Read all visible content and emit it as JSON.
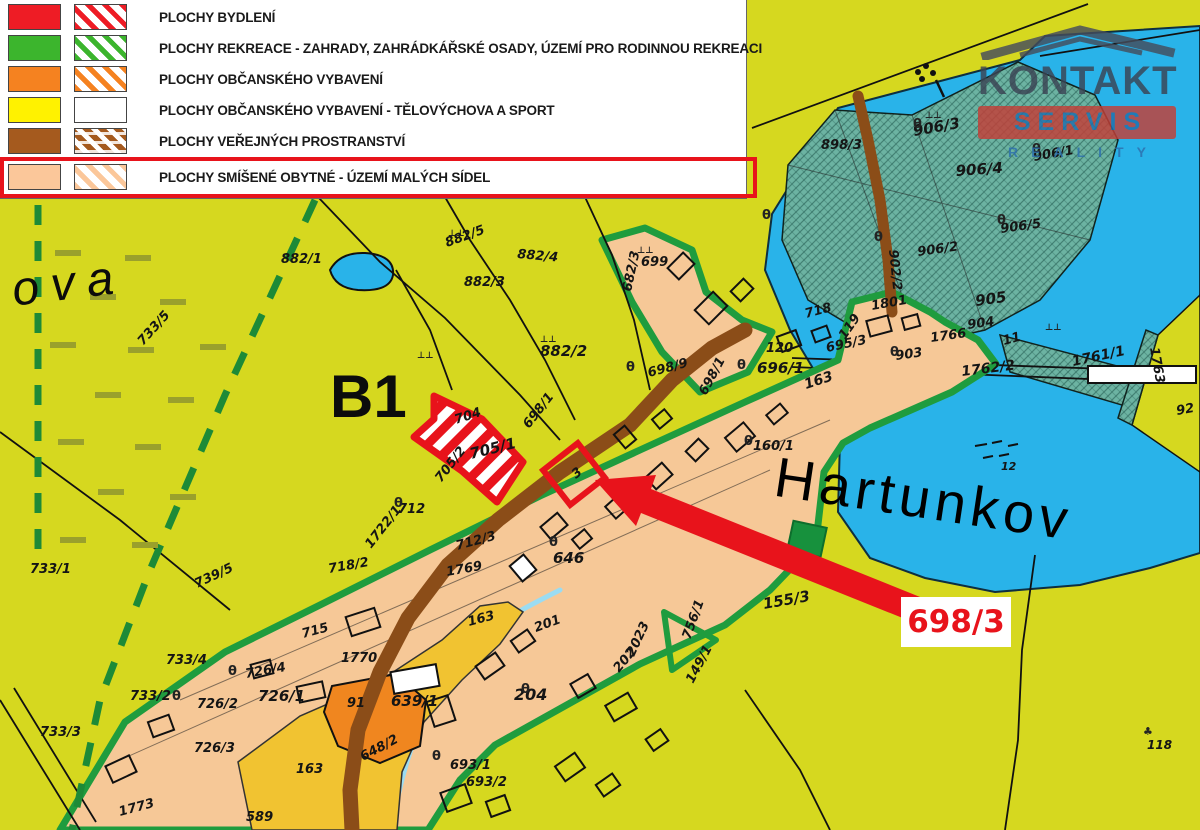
{
  "map": {
    "place_label": "Hartunkov",
    "partial_place_label": "ova",
    "zone_label": "B1",
    "callout": {
      "text": "698/3"
    },
    "colors": {
      "field": "#d6d81f",
      "lake": "#29b3e9",
      "teal": "#6cb3a2",
      "village": "#f6c897",
      "green": "#1f9c3e",
      "road": "#8b4d18",
      "gold": "#f1c331",
      "orange": "#f0861f",
      "red": "#e8131b"
    },
    "parcel_labels": [
      {
        "t": "882/5",
        "x": 447,
        "y": 247,
        "r": -20
      },
      {
        "t": "882/4",
        "x": 517,
        "y": 258,
        "r": 5
      },
      {
        "t": "882/3",
        "x": 464,
        "y": 286,
        "r": 0
      },
      {
        "t": "882/2",
        "x": 540,
        "y": 356,
        "r": 0,
        "s": 15
      },
      {
        "t": "882/1",
        "x": 281,
        "y": 263,
        "r": 0
      },
      {
        "t": "733/5",
        "x": 143,
        "y": 346,
        "r": -48
      },
      {
        "t": "733/1",
        "x": 30,
        "y": 573,
        "r": 0
      },
      {
        "t": "733/4",
        "x": 166,
        "y": 664,
        "r": 0
      },
      {
        "t": "733/2",
        "x": 130,
        "y": 700,
        "r": 0
      },
      {
        "t": "733/3",
        "x": 40,
        "y": 736,
        "r": 0
      },
      {
        "t": "739/5",
        "x": 197,
        "y": 588,
        "r": -25
      },
      {
        "t": "726/4",
        "x": 246,
        "y": 678,
        "r": -10
      },
      {
        "t": "726/1",
        "x": 258,
        "y": 701,
        "r": 0,
        "s": 15
      },
      {
        "t": "726/2",
        "x": 197,
        "y": 708,
        "r": 0
      },
      {
        "t": "726/3",
        "x": 194,
        "y": 752,
        "r": 0
      },
      {
        "t": "715",
        "x": 303,
        "y": 638,
        "r": -15
      },
      {
        "t": "718/2",
        "x": 329,
        "y": 573,
        "r": -10
      },
      {
        "t": "1770",
        "x": 341,
        "y": 662,
        "r": 0
      },
      {
        "t": "1773",
        "x": 120,
        "y": 816,
        "r": -15
      },
      {
        "t": "589",
        "x": 246,
        "y": 821,
        "r": 0
      },
      {
        "t": "639/1",
        "x": 391,
        "y": 706,
        "r": 0,
        "s": 15
      },
      {
        "t": "91",
        "x": 347,
        "y": 707,
        "r": 0
      },
      {
        "t": "648/2",
        "x": 363,
        "y": 761,
        "r": -28
      },
      {
        "t": "163",
        "x": 296,
        "y": 773,
        "r": 0
      },
      {
        "t": "163",
        "x": 469,
        "y": 626,
        "r": -15
      },
      {
        "t": "201",
        "x": 536,
        "y": 632,
        "r": -20
      },
      {
        "t": "204",
        "x": 514,
        "y": 700,
        "r": 0,
        "s": 16
      },
      {
        "t": "202",
        "x": 619,
        "y": 673,
        "r": -50
      },
      {
        "t": "2023",
        "x": 634,
        "y": 657,
        "r": -65
      },
      {
        "t": "693/1",
        "x": 450,
        "y": 769,
        "r": 0
      },
      {
        "t": "693/2",
        "x": 466,
        "y": 786,
        "r": 0
      },
      {
        "t": "712",
        "x": 398,
        "y": 513,
        "r": 0
      },
      {
        "t": "712/3",
        "x": 457,
        "y": 550,
        "r": -15
      },
      {
        "t": "1769",
        "x": 447,
        "y": 576,
        "r": -10
      },
      {
        "t": "1722/1",
        "x": 371,
        "y": 549,
        "r": -52
      },
      {
        "t": "704",
        "x": 456,
        "y": 424,
        "r": -18
      },
      {
        "t": "705/1",
        "x": 471,
        "y": 459,
        "r": -14,
        "s": 15
      },
      {
        "t": "705/2",
        "x": 441,
        "y": 483,
        "r": -52
      },
      {
        "t": "698/1",
        "x": 529,
        "y": 429,
        "r": -52
      },
      {
        "t": "3",
        "x": 576,
        "y": 479,
        "r": -40
      },
      {
        "t": "698/9",
        "x": 649,
        "y": 377,
        "r": -15
      },
      {
        "t": "698/1",
        "x": 706,
        "y": 396,
        "r": -62
      },
      {
        "t": "696/1",
        "x": 757,
        "y": 373,
        "r": 0,
        "s": 15
      },
      {
        "t": "120",
        "x": 766,
        "y": 352,
        "r": 0
      },
      {
        "t": "718",
        "x": 806,
        "y": 318,
        "r": -15
      },
      {
        "t": "695/3",
        "x": 827,
        "y": 352,
        "r": -12
      },
      {
        "t": "119",
        "x": 845,
        "y": 340,
        "r": -55
      },
      {
        "t": "163",
        "x": 806,
        "y": 389,
        "r": -18,
        "s": 14
      },
      {
        "t": "160/1",
        "x": 753,
        "y": 450,
        "r": 0
      },
      {
        "t": "646",
        "x": 553,
        "y": 563,
        "r": 0,
        "s": 15
      },
      {
        "t": "699",
        "x": 641,
        "y": 266,
        "r": 0
      },
      {
        "t": "682/3",
        "x": 631,
        "y": 292,
        "r": -78
      },
      {
        "t": "1801",
        "x": 872,
        "y": 310,
        "r": -10
      },
      {
        "t": "903",
        "x": 896,
        "y": 360,
        "r": -8
      },
      {
        "t": "1766",
        "x": 931,
        "y": 342,
        "r": -8
      },
      {
        "t": "11",
        "x": 1004,
        "y": 345,
        "r": -15
      },
      {
        "t": "1762/2",
        "x": 962,
        "y": 376,
        "r": -7,
        "s": 14
      },
      {
        "t": "1761/1",
        "x": 1073,
        "y": 366,
        "r": -12,
        "s": 14
      },
      {
        "t": "92",
        "x": 1177,
        "y": 415,
        "r": -10
      },
      {
        "t": "905",
        "x": 976,
        "y": 306,
        "r": -8,
        "s": 15
      },
      {
        "t": "904",
        "x": 968,
        "y": 329,
        "r": -8
      },
      {
        "t": "898/3",
        "x": 821,
        "y": 149,
        "r": 0
      },
      {
        "t": "906/3",
        "x": 914,
        "y": 136,
        "r": -10,
        "s": 15
      },
      {
        "t": "906/4",
        "x": 956,
        "y": 176,
        "r": -4,
        "s": 15
      },
      {
        "t": "906/1",
        "x": 1034,
        "y": 161,
        "r": -10
      },
      {
        "t": "906/5",
        "x": 1001,
        "y": 233,
        "r": -8
      },
      {
        "t": "906/2",
        "x": 918,
        "y": 256,
        "r": -8
      },
      {
        "t": "902/2",
        "x": 889,
        "y": 250,
        "r": 84
      },
      {
        "t": "12",
        "x": 1001,
        "y": 470,
        "r": 0,
        "s": 11
      },
      {
        "t": "118",
        "x": 1147,
        "y": 749,
        "r": 0,
        "s": 12
      },
      {
        "t": "155/3",
        "x": 764,
        "y": 609,
        "r": -10,
        "s": 15
      },
      {
        "t": "756/1",
        "x": 690,
        "y": 640,
        "r": -70
      },
      {
        "t": "149/1",
        "x": 693,
        "y": 684,
        "r": -62
      },
      {
        "t": "1763",
        "x": 1150,
        "y": 348,
        "r": 80
      }
    ],
    "symbols": {
      "theta_glyph": "θ",
      "theta_positions": [
        [
          626,
          371
        ],
        [
          737,
          369
        ],
        [
          744,
          445
        ],
        [
          549,
          546
        ],
        [
          394,
          507
        ],
        [
          172,
          700
        ],
        [
          228,
          675
        ],
        [
          432,
          760
        ],
        [
          521,
          693
        ],
        [
          913,
          128
        ],
        [
          874,
          241
        ],
        [
          997,
          224
        ],
        [
          1032,
          153
        ],
        [
          762,
          219
        ],
        [
          890,
          356
        ]
      ],
      "grass_glyph": "⊥⊥",
      "grass_positions": [
        [
          448,
          236
        ],
        [
          540,
          342
        ],
        [
          417,
          358
        ],
        [
          637,
          253
        ],
        [
          925,
          118
        ],
        [
          1045,
          330
        ]
      ],
      "tree_glyph": "♣",
      "tree_positions": [
        [
          1143,
          735
        ]
      ]
    }
  },
  "legend": {
    "items": [
      {
        "label": "PLOCHY BYDLENÍ",
        "solid": "#ee1c25",
        "hatch": "#ee1c25",
        "hatch_style": "diagonal",
        "highlighted": false
      },
      {
        "label": "PLOCHY REKREACE - ZAHRADY, ZAHRÁDKÁŘSKÉ OSADY, ÚZEMÍ PRO RODINNOU REKREACI",
        "solid": "#3cb52d",
        "hatch": "#3cb52d",
        "hatch_style": "diagonal",
        "highlighted": false
      },
      {
        "label": "PLOCHY OBČANSKÉHO VYBAVENÍ",
        "solid": "#f58220",
        "hatch": "#f58220",
        "hatch_style": "diagonal",
        "highlighted": false
      },
      {
        "label": "PLOCHY OBČANSKÉHO VYBAVENÍ - TĚLOVÝCHOVA A SPORT",
        "solid": "#fff200",
        "hatch": "",
        "hatch_style": "none",
        "highlighted": false
      },
      {
        "label": "PLOCHY VEŘEJNÝCH PROSTRANSTVÍ",
        "solid": "#a55a1e",
        "hatch": "#a55a1e",
        "hatch_style": "crosshatch",
        "highlighted": false
      },
      {
        "label": "PLOCHY SMÍŠENÉ OBYTNÉ - ÚZEMÍ MALÝCH SÍDEL",
        "solid": "#fbc79a",
        "hatch": "#fbc79a",
        "hatch_style": "diagonal",
        "highlighted": true
      }
    ]
  },
  "watermark": {
    "line1": "KONTAKT",
    "line2": "SERVIS",
    "line3": "REALITY"
  }
}
